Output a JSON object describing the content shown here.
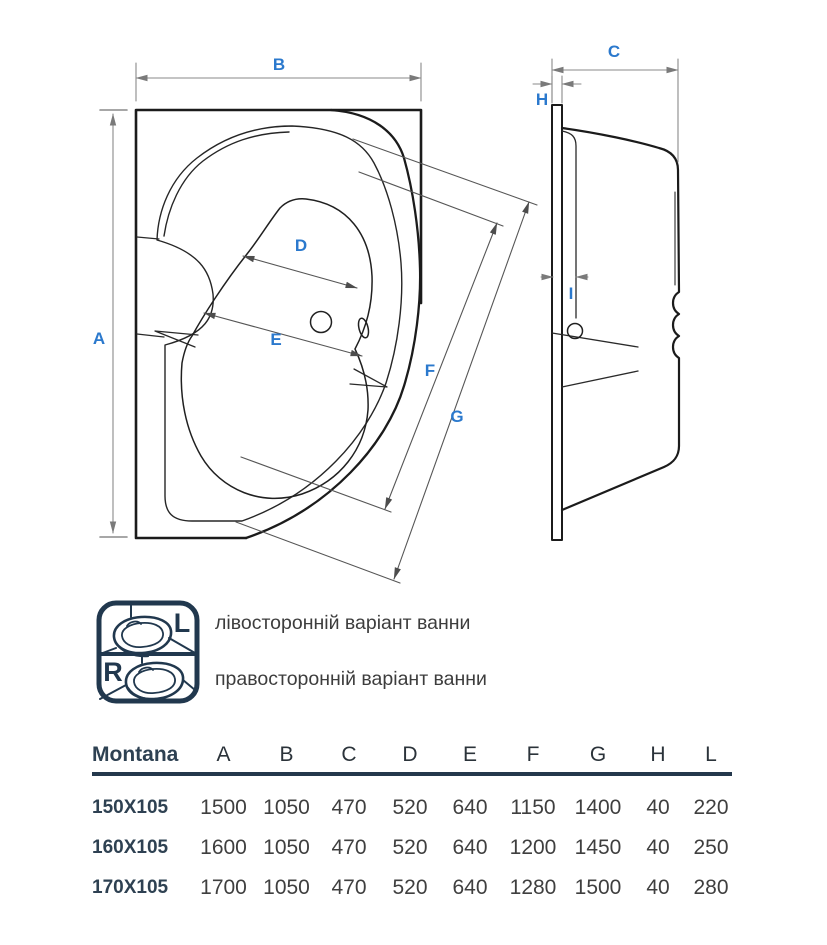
{
  "colors": {
    "accent_blue": "#2b79cd",
    "navy": "#21384e",
    "drawing_line": "#1c1c1c",
    "dim_line_gray": "#8a8a8a",
    "dim_line_dark": "#565656",
    "text_dark": "#3d3d3d"
  },
  "dim_labels": {
    "A": "A",
    "B": "B",
    "C": "C",
    "D": "D",
    "E": "E",
    "F": "F",
    "G": "G",
    "H": "H",
    "I": "I"
  },
  "legend": {
    "items": [
      {
        "letter": "L",
        "label": "лівосторонній варіант ванни"
      },
      {
        "letter": "R",
        "label": "правосторонній варіант ванни"
      }
    ]
  },
  "table": {
    "brand": "Montana",
    "columns": [
      "A",
      "B",
      "C",
      "D",
      "E",
      "F",
      "G",
      "H",
      "L"
    ],
    "rows": [
      {
        "size": "150X105",
        "values": [
          "1500",
          "1050",
          "470",
          "520",
          "640",
          "1150",
          "1400",
          "40",
          "220"
        ]
      },
      {
        "size": "160X105",
        "values": [
          "1600",
          "1050",
          "470",
          "520",
          "640",
          "1200",
          "1450",
          "40",
          "250"
        ]
      },
      {
        "size": "170X105",
        "values": [
          "1700",
          "1050",
          "470",
          "520",
          "640",
          "1280",
          "1500",
          "40",
          "280"
        ]
      }
    ]
  }
}
